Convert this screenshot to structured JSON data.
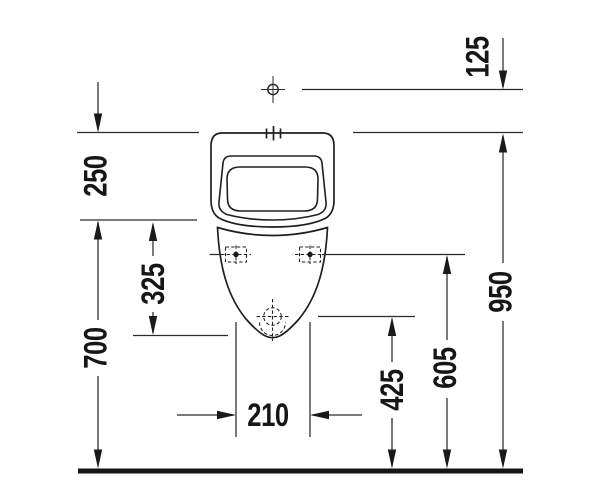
{
  "drawing_type": "technical-dimension-drawing",
  "colors": {
    "ink": "#1f1f1f",
    "background": "#ffffff"
  },
  "dims": {
    "d125": "125",
    "d250": "250",
    "d325": "325",
    "d700": "700",
    "d950": "950",
    "d605": "605",
    "d425": "425",
    "d210": "210"
  }
}
